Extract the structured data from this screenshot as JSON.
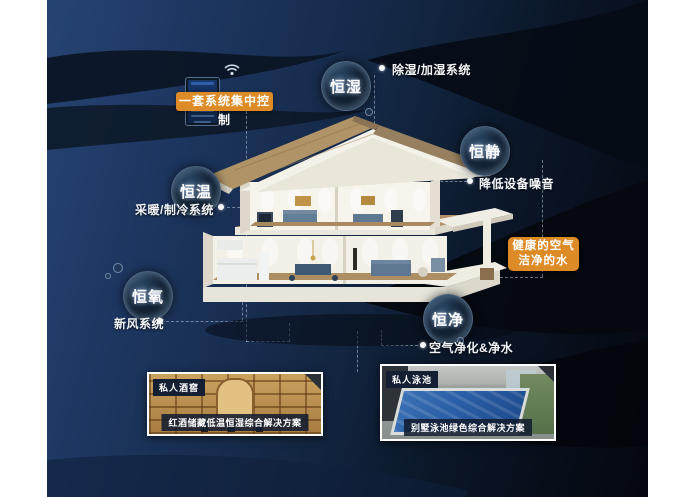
{
  "scene": {
    "bg_left": "#1d3660",
    "bg_right": "#04070d",
    "accent_orange": "#dd8b26",
    "line_color": "rgba(200,215,235,0.5)"
  },
  "control": {
    "box_label": "一套系统集中控制"
  },
  "health": {
    "line1": "健康的空气",
    "line2": "洁净的水"
  },
  "features": [
    {
      "bubble": "恒湿",
      "desc": "除湿/加湿系统"
    },
    {
      "bubble": "恒静",
      "desc": "降低设备噪音"
    },
    {
      "bubble": "恒温",
      "desc": "采暖/制冷系统"
    },
    {
      "bubble": "恒氧",
      "desc": "新风系统"
    },
    {
      "bubble": "恒净",
      "desc": "空气净化&净水"
    }
  ],
  "photos": [
    {
      "tag": "私人酒窖",
      "caption": "红酒储藏低温恒湿综合解决方案"
    },
    {
      "tag": "私人泳池",
      "caption": "别墅泳池绿色综合解决方案"
    }
  ]
}
